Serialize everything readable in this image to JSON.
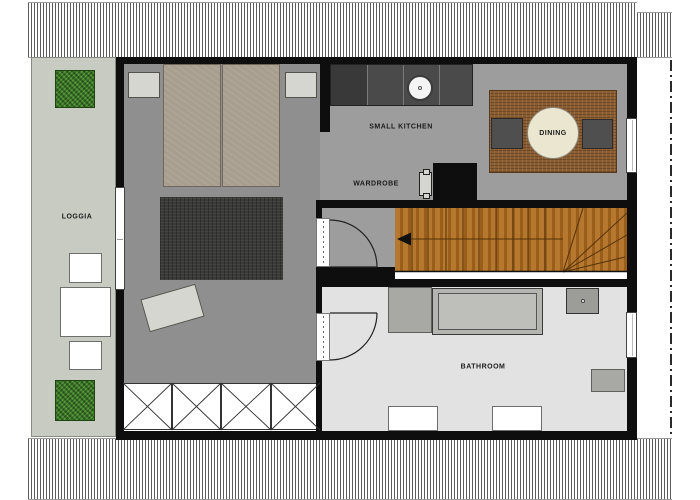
{
  "rooms": {
    "loggia": {
      "label": "LOGGIA"
    },
    "kitchen": {
      "label": "SMALL KITCHEN"
    },
    "wardrobe": {
      "label": "WARDROBE"
    },
    "dining": {
      "label": "DINING"
    },
    "bathroom": {
      "label": "BATHROOM"
    }
  },
  "colors": {
    "wall": "#0e0e0e",
    "floor_bedroom": "#8f8f8f",
    "floor_living": "#9d9d9d",
    "floor_bathroom": "#e2e2e2",
    "floor_loggia": "#c7cbc2",
    "wood_stairs": "#a5671e",
    "rug_dining": "#8a5c30",
    "rug_bedroom": "#3a3a38",
    "plant_green": "#3a7a28",
    "table_cream": "#eae6cf",
    "counter_dark": "#4a4a4a",
    "furniture_light": "#d6d6d1",
    "mattress": "#a89e90"
  }
}
